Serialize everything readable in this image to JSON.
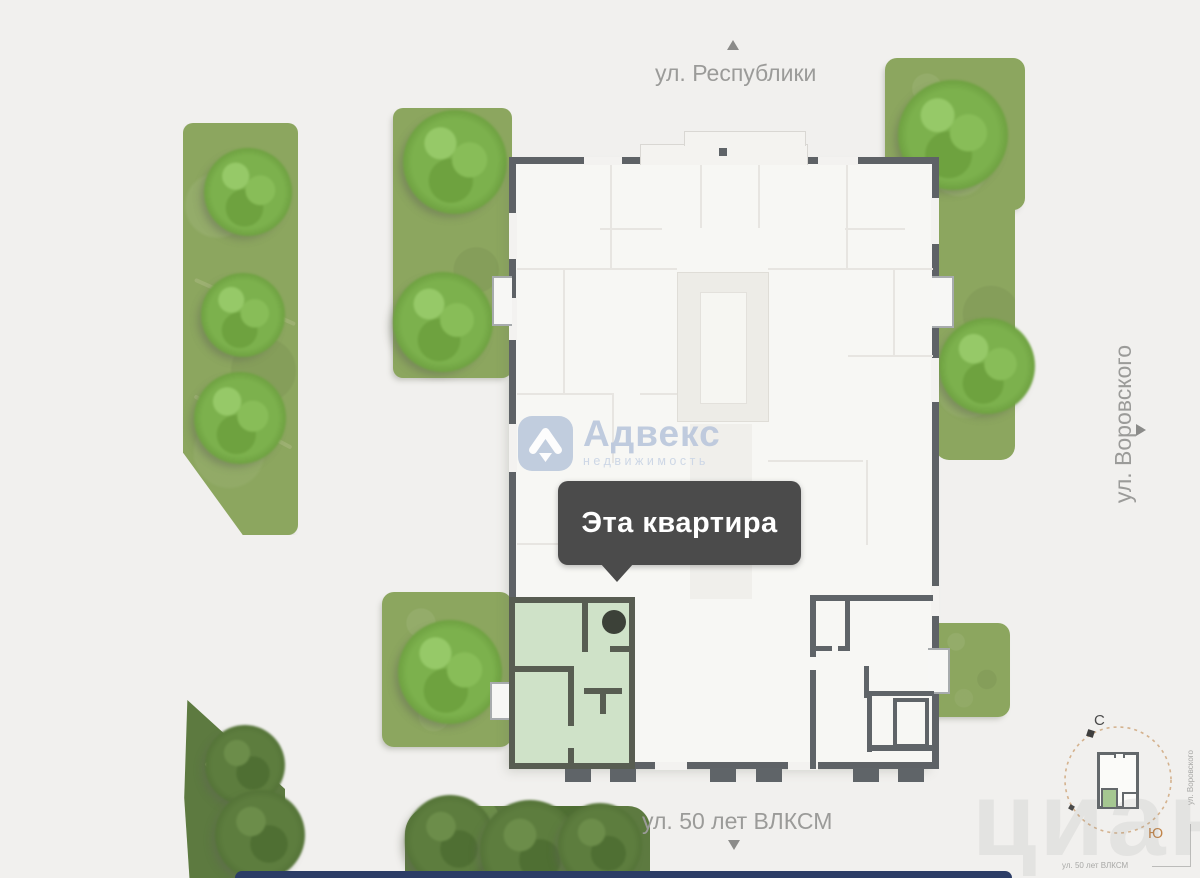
{
  "map": {
    "streets": {
      "top": {
        "label": "ул. Республики"
      },
      "right": {
        "label": "ул. Воровского"
      },
      "bottom": {
        "label": "ул. 50 лет ВЛКСМ"
      }
    },
    "tooltip": {
      "label": "Эта квартира"
    },
    "brand_watermark": {
      "name": "Адвекс",
      "subtitle": "недвижимость"
    },
    "site_watermark": {
      "text": "циан"
    },
    "compass": {
      "north": "С",
      "south": "Ю",
      "street_right": "ул. Воровского",
      "street_bottom": "ул. 50 лет ВЛКСМ"
    }
  },
  "colors": {
    "background": "#f1f0ee",
    "lawn": "#8ca65f",
    "tree": "#7cb14d",
    "building_fill": "#f7f7f4",
    "wall": "#5e6266",
    "highlight_apartment_fill": "#cfe2c8",
    "highlight_apartment_wall": "#585d52",
    "tooltip_bg": "#4b4b4b",
    "tooltip_text": "#ffffff",
    "street_label": "#9b9b99",
    "compass_ring": "#d4b28e",
    "compass_south": "#c08449",
    "brand_blue": "#b6c4da",
    "bottom_bar": "#2c3d66"
  }
}
